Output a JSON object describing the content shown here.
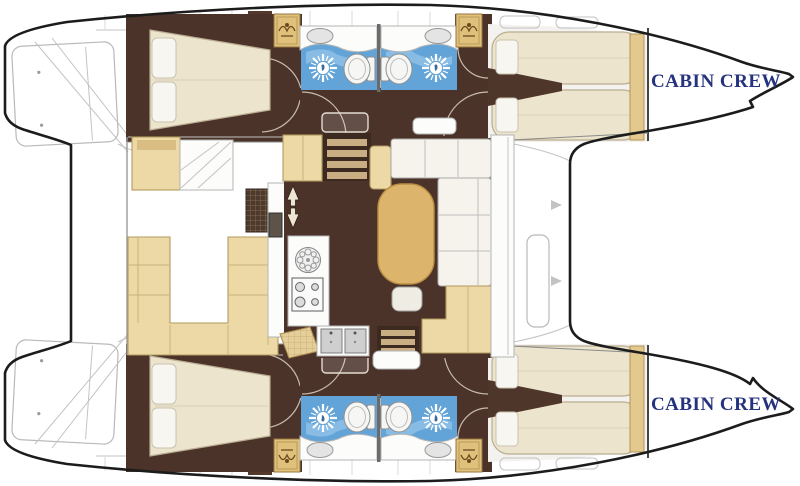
{
  "diagram": {
    "type": "catamaran-deck-plan",
    "description": "Top-down layout plan of a 4-cabin catamaran with twin bow crew cabins"
  },
  "labels": {
    "cabin_crew": "CABIN CREW"
  },
  "colors": {
    "hull_outline": "#1c1c1c",
    "floor_brown": "#4b332a",
    "stair_brown": "#3c2a21",
    "upholstery_cream": "#ece4cd",
    "sofa_tan": "#ecd9a6",
    "locker_gold": "#dfc17c",
    "table_wood": "#ddb46b",
    "wet_room_blue": "#63a4d8",
    "label_navy": "#25327d",
    "outline_gray": "#b9b9b9"
  },
  "icons": [
    "shower-sunburst-icon",
    "toilet-icon",
    "vanity-sink-icon",
    "round-burner-icon",
    "stove-burners-icon",
    "twin-sinks-icon",
    "stairs-icon",
    "direction-arrows-icon",
    "wardrobe-icon"
  ]
}
